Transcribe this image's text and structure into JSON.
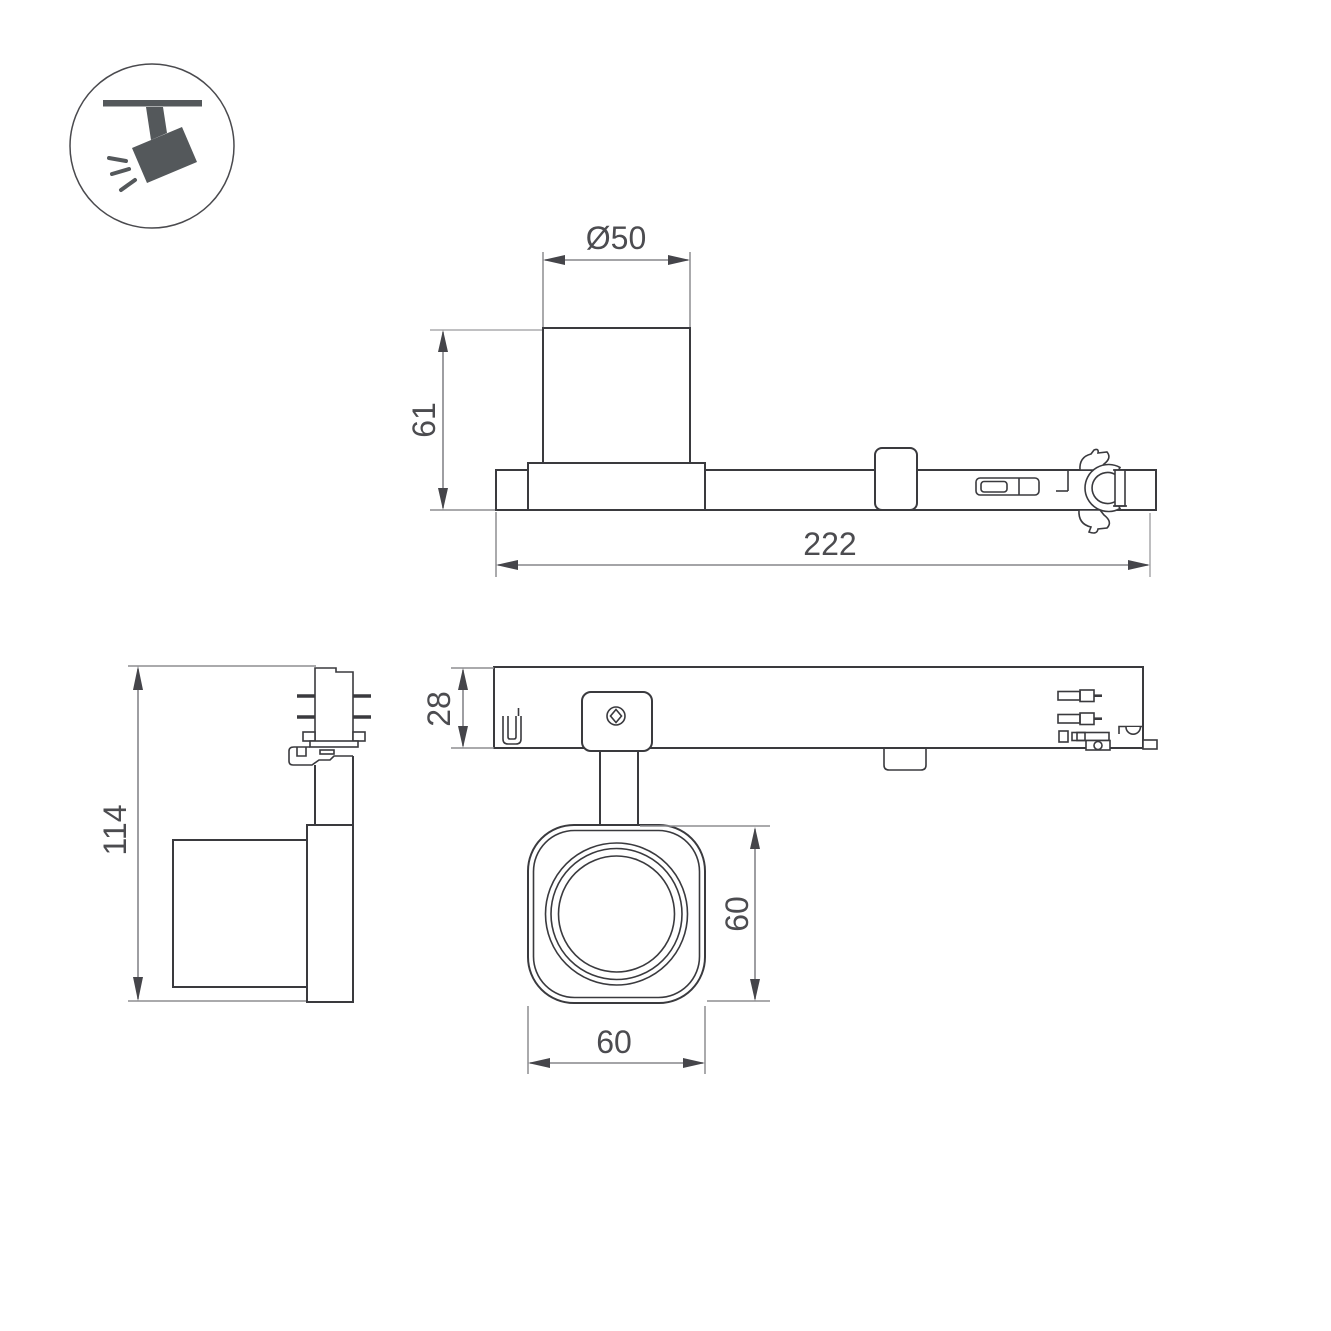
{
  "meta": {
    "title": "Track-mounted spotlight technical drawing",
    "background": "#ffffff"
  },
  "colors": {
    "object_line": "#3a3a3e",
    "dimension_line": "#85858a",
    "extension_line_light": "#b7b7b9",
    "arrow": "#45454a",
    "text": "#4c4c50",
    "icon_fill": "#54585b"
  },
  "icon": {
    "name": "track-spotlight-pictogram",
    "description": "ceiling track with tilted spotlight emitting light"
  },
  "views": {
    "side": {
      "name": "side-view",
      "dimensions": [
        {
          "id": "lens-diameter",
          "label": "Ø50"
        },
        {
          "id": "height-above-track",
          "label": "61"
        },
        {
          "id": "track-length",
          "label": "222"
        }
      ]
    },
    "front": {
      "name": "front-view",
      "dimensions": [
        {
          "id": "total-height",
          "label": "114"
        }
      ]
    },
    "top": {
      "name": "top-view",
      "dimensions": [
        {
          "id": "track-width",
          "label": "28"
        },
        {
          "id": "head-height",
          "label": "60"
        },
        {
          "id": "head-width",
          "label": "60"
        }
      ]
    }
  }
}
